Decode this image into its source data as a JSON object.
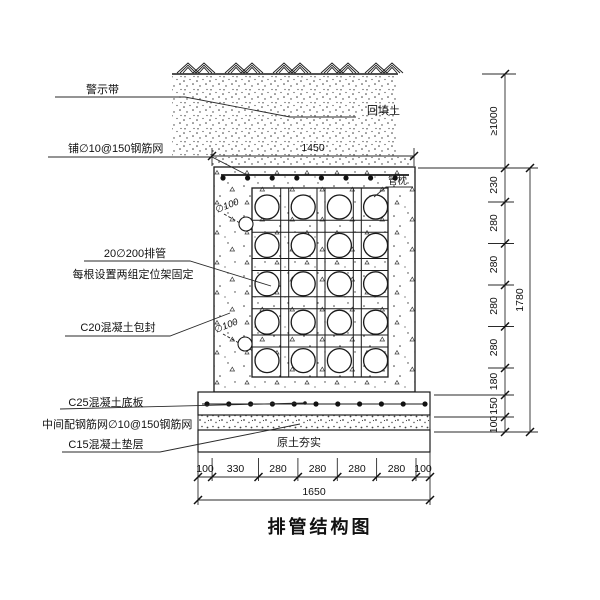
{
  "title": "排管结构图",
  "drawing": {
    "labels": {
      "warning_tape": "警示带",
      "top_mesh": "铺∅10@150钢筋网",
      "backfill": "回填土",
      "pipe_pillow": "管枕",
      "pipe_bank_line1": "20∅200排管",
      "pipe_bank_line2": "每根设置两组定位架固定",
      "encasement": "C20混凝土包封",
      "base_slab": "C25混凝土底板",
      "slab_mesh": "中间配钢筋网∅10@150钢筋网",
      "cushion": "C15混凝土垫层",
      "compacted_soil": "原土夯实",
      "drain_pipe_upper": "∅100",
      "drain_pipe_lower": "∅100"
    },
    "dimensions": {
      "top_width": "1450",
      "bottom_segments": [
        "100",
        "330",
        "280",
        "280",
        "280",
        "280",
        "100"
      ],
      "bottom_total": "1650",
      "cover_depth": "≥1000",
      "right_segments": [
        "230",
        "280",
        "280",
        "280",
        "280",
        "180",
        "150",
        "100"
      ],
      "right_total": "1780"
    },
    "colors": {
      "line": "#1a1a1a",
      "background": "#ffffff"
    }
  }
}
